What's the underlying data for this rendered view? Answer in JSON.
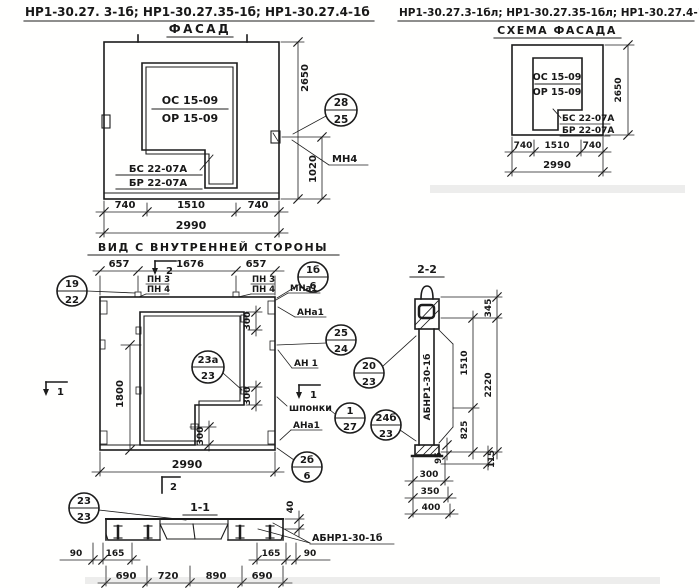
{
  "titles": {
    "left_marks": "НР1-30.27. 3-1б;  НР1-30.27.35-1б;  НР1-30.27.4-1б",
    "right_marks": "НР1-30.27.3-1бл; НР1-30.27.35-1бл; НР1-30.27.4-1бл"
  },
  "facade": {
    "title": "ФАСАД",
    "os": "ОС 15-09",
    "or": "ОР 15-09",
    "bs": "БС 22-07А",
    "br": "БР 22-07А",
    "mn4": "МН4",
    "callout": {
      "top": "28",
      "bot": "25"
    },
    "d740": "740",
    "d1510": "1510",
    "d2990": "2990",
    "d2650": "2650",
    "d1020": "1020"
  },
  "scheme": {
    "title": "СХЕМА ФАСАДА",
    "os": "ОС 15-09",
    "or": "ОР 15-09",
    "bs": "БС 22-07А",
    "br": "БР 22-07А",
    "d740": "740",
    "d1510": "1510",
    "d2990": "2990",
    "d2650": "2650"
  },
  "inner": {
    "title": "ВИД С ВНУТРЕННЕЙ СТОРОНЫ",
    "d657": "657",
    "d1676": "1676",
    "d1800": "1800",
    "d300": "300",
    "d2990": "2990",
    "pn3": "ПН 3",
    "pn4": "ПН 4",
    "mna1": "МНа1",
    "ana1": "АНа1",
    "an1": "АН 1",
    "shponki": "шпонки",
    "m1": "1",
    "m2": "2",
    "c19": {
      "top": "19",
      "bot": "22"
    },
    "c1b": {
      "top": "1б",
      "bot": "6"
    },
    "c25": {
      "top": "25",
      "bot": "24"
    },
    "c23a": {
      "top": "23а",
      "bot": "23"
    },
    "c20": {
      "top": "20",
      "bot": "23"
    },
    "c127": {
      "top": "1",
      "bot": "27"
    },
    "c24b": {
      "top": "24б",
      "bot": "23"
    },
    "c2b": {
      "top": "2б",
      "bot": "6"
    }
  },
  "s11": {
    "title": "1-1",
    "callout": {
      "top": "23",
      "bot": "23"
    },
    "beam": "АБНР1-30-1б",
    "d40": "40",
    "d90": "90",
    "d165": "165",
    "d690": "690",
    "d720": "720",
    "d890": "890"
  },
  "s22": {
    "title": "2-2",
    "beam": "АБНР1-30-1б",
    "d345": "345",
    "d1510": "1510",
    "d2220": "2220",
    "d825": "825",
    "d95": "95",
    "d115": "115",
    "d300": "300",
    "d350": "350",
    "d400": "400"
  }
}
